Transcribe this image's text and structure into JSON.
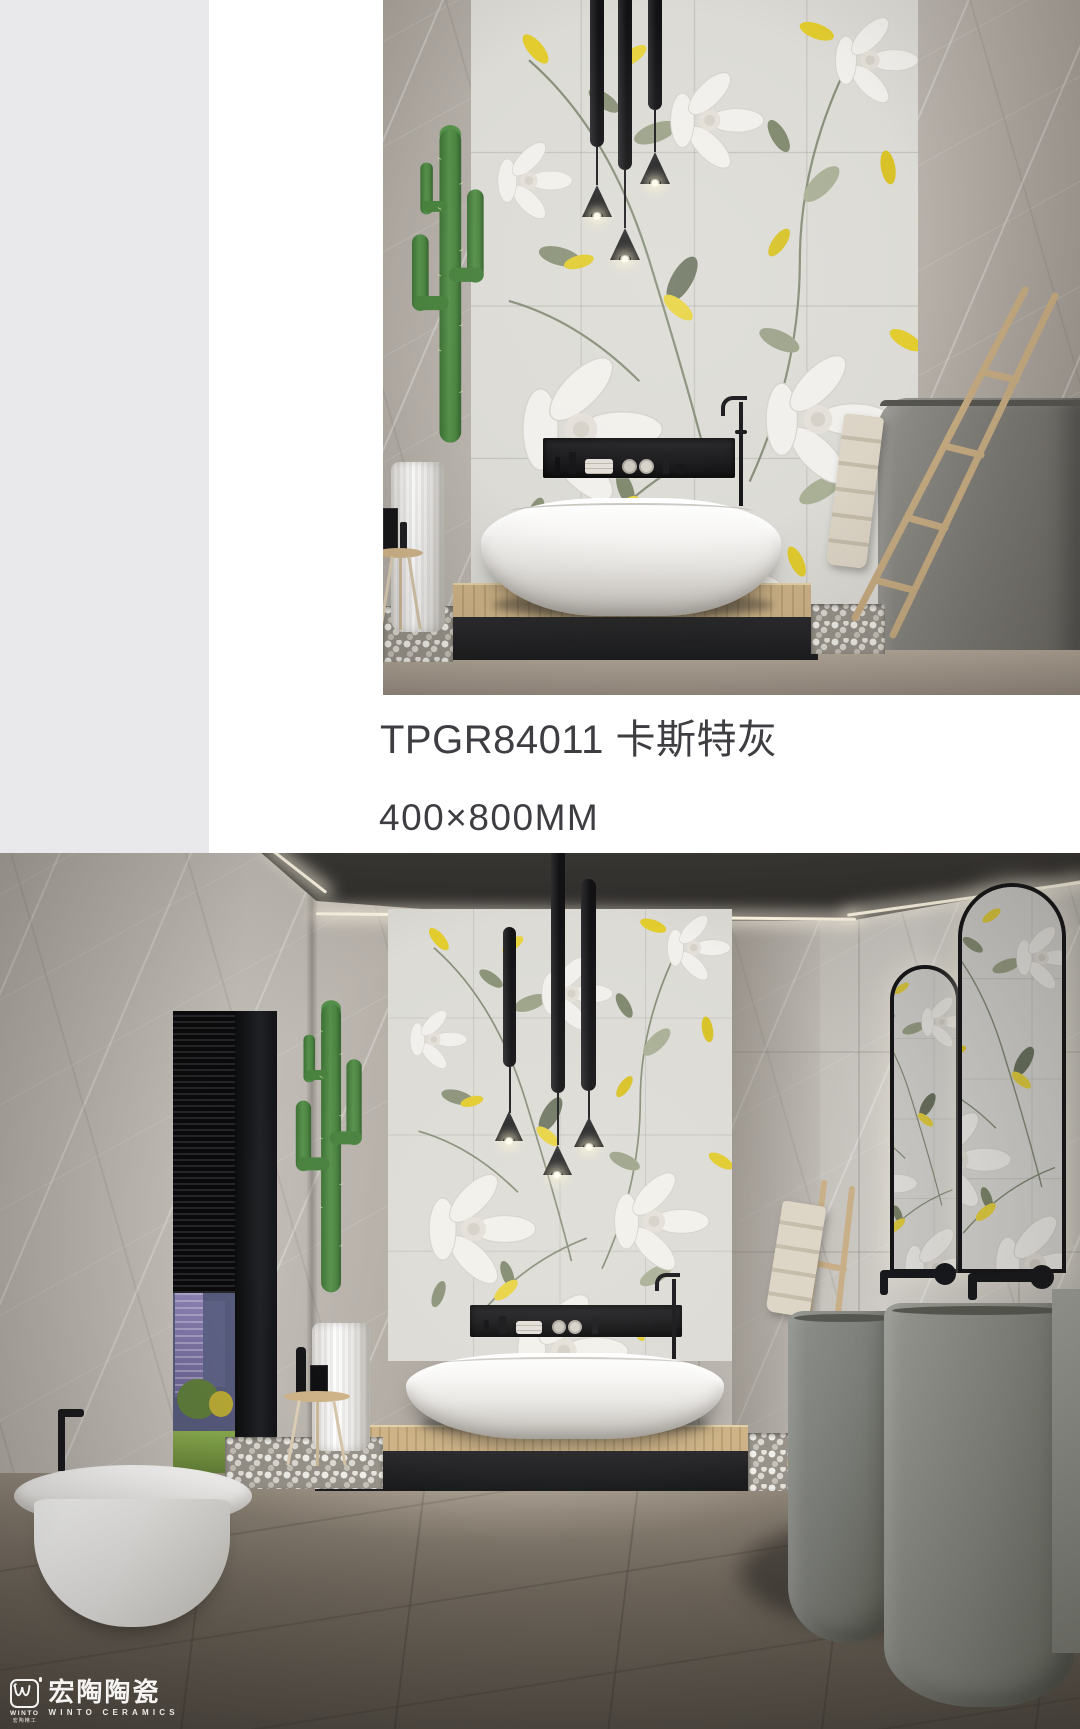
{
  "page": {
    "width": 1080,
    "height": 1729,
    "background": "#ffffff",
    "sidebar_color": "#e9e9eb"
  },
  "product": {
    "code": "TPGR84011",
    "name": "卡斯特灰",
    "code_line": "TPGR84011 卡斯特灰",
    "size": "400×800MM",
    "text_color": "#3e3e42"
  },
  "brand": {
    "name_cn": "宏陶陶瓷",
    "name_en": "WINTO CERAMICS",
    "mark_text": "WINTO",
    "mark_sub_cn": "宏陶精工",
    "logo_color": "#f5f4f2"
  },
  "palette": {
    "accent_yellow": "#e3cd2f",
    "marble_gray": "#bcb6b0",
    "mural_background": "#dcdbd6",
    "floor_taupe": "#6f675c",
    "plinth_black": "#26262a",
    "wood": "#cbb285",
    "cactus_green": "#4d8843",
    "pendant_black": "#1b1b1d",
    "stone_gray": "#7c7e7a"
  }
}
